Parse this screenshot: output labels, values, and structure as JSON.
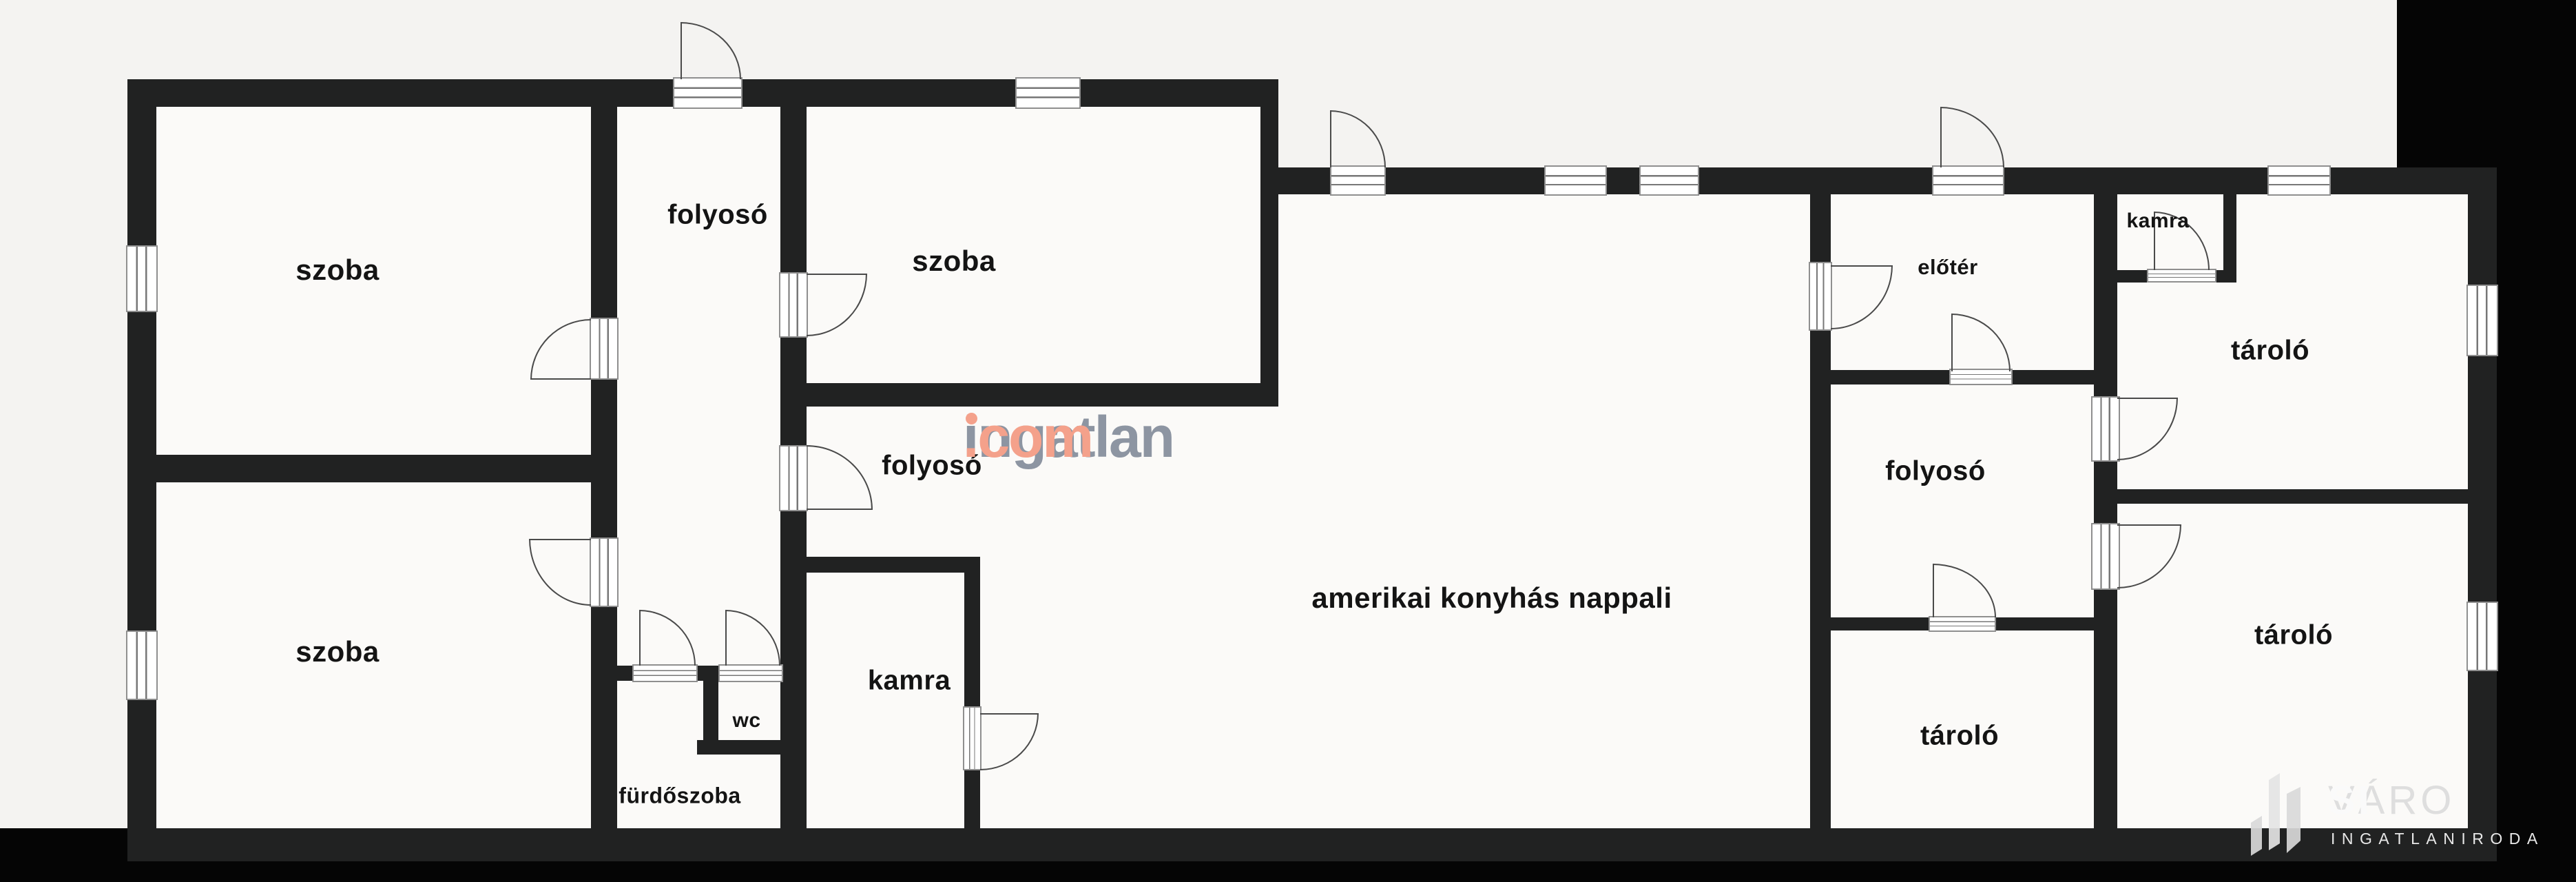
{
  "plan": {
    "background": "#f4f3f1",
    "room_fill": "#fbfaf8",
    "wall_color": "#212222"
  },
  "rooms": [
    {
      "label": "szoba"
    },
    {
      "label": "szoba"
    },
    {
      "label": "folyosó"
    },
    {
      "label": "szoba"
    },
    {
      "label": "folyosó"
    },
    {
      "label": "kamra"
    },
    {
      "label": "wc"
    },
    {
      "label": "fürdőszoba"
    },
    {
      "label": "amerikai konyhás nappali"
    },
    {
      "label": "előtér"
    },
    {
      "label": "kamra"
    },
    {
      "label": "tároló"
    },
    {
      "label": "folyosó"
    },
    {
      "label": "tároló"
    },
    {
      "label": "tároló"
    }
  ],
  "watermark": {
    "brand": "ingatlan",
    "tld": ".com",
    "brand_color": "#8d95a2",
    "accent_color": "#f4a18b"
  },
  "logo": {
    "name_light": "VÁRO",
    "name_bold": "SI",
    "subtitle": "INGATLANIRODA"
  }
}
